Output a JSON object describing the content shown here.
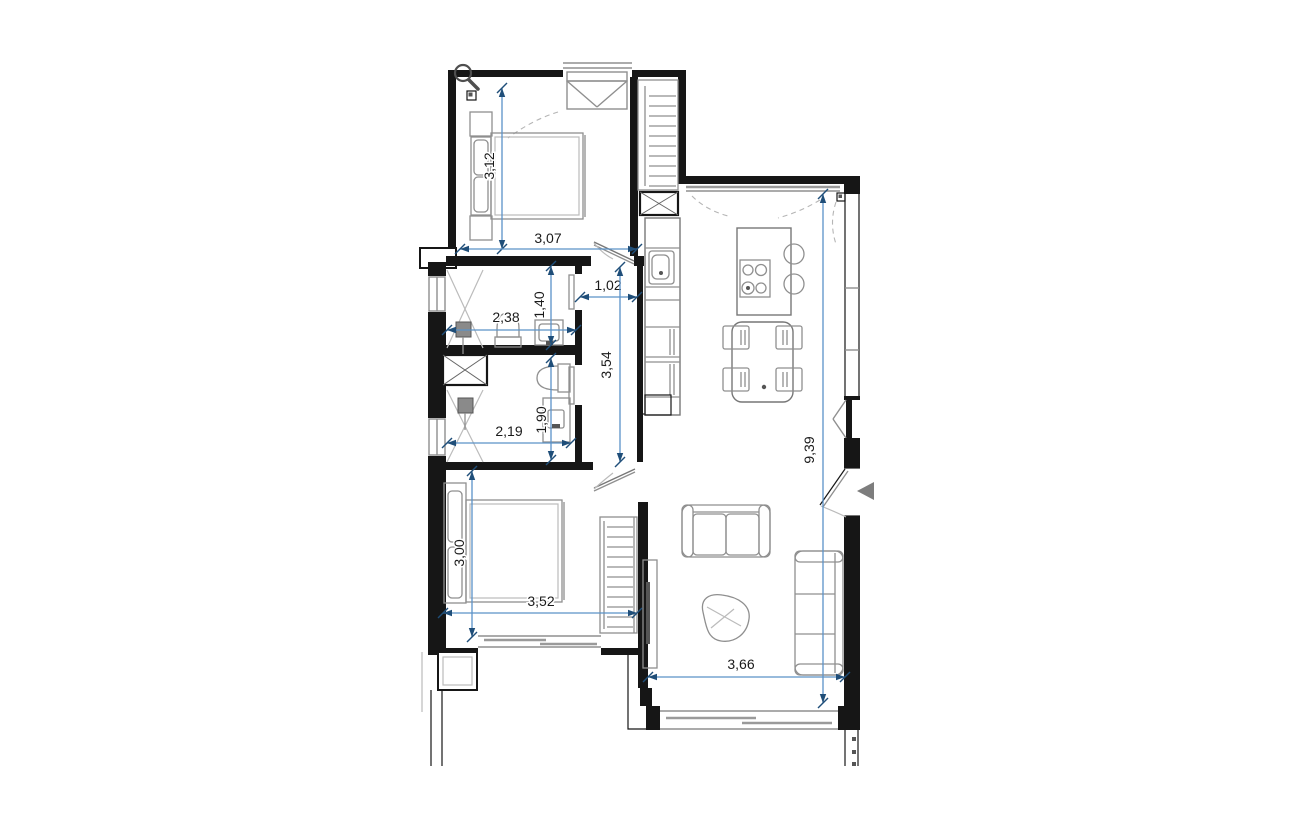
{
  "drawing_type": "apartment-floor-plan",
  "colors": {
    "background": "#ffffff",
    "wall": "#161616",
    "furniture": "#8f8f8f",
    "dimension_line": "#5b92c8",
    "dimension_arrow": "#1f4e79",
    "dimension_text": "#1a1a1a",
    "entrance_marker": "#7d7d7d"
  },
  "icons": {
    "magnifier_cursor": "magnifying-glass",
    "entrance_marker": "solid-left-arrow"
  },
  "dimensions": [
    {
      "id": "bedroom1-depth",
      "value": "3,12",
      "orientation": "vertical"
    },
    {
      "id": "bedroom1-width",
      "value": "3,07",
      "orientation": "horizontal"
    },
    {
      "id": "hallway-width",
      "value": "1,02",
      "orientation": "horizontal"
    },
    {
      "id": "bathroom1-width",
      "value": "2,38",
      "orientation": "horizontal"
    },
    {
      "id": "bathroom1-depth",
      "value": "1,40",
      "orientation": "vertical"
    },
    {
      "id": "hallway-length",
      "value": "3,54",
      "orientation": "vertical"
    },
    {
      "id": "living-length",
      "value": "9,39",
      "orientation": "vertical"
    },
    {
      "id": "bathroom2-width",
      "value": "2,19",
      "orientation": "horizontal"
    },
    {
      "id": "bathroom2-depth",
      "value": "1,90",
      "orientation": "vertical"
    },
    {
      "id": "bedroom2-depth",
      "value": "3,00",
      "orientation": "vertical"
    },
    {
      "id": "bedroom2-width",
      "value": "3,52",
      "orientation": "horizontal"
    },
    {
      "id": "living-width",
      "value": "3,66",
      "orientation": "horizontal"
    }
  ]
}
